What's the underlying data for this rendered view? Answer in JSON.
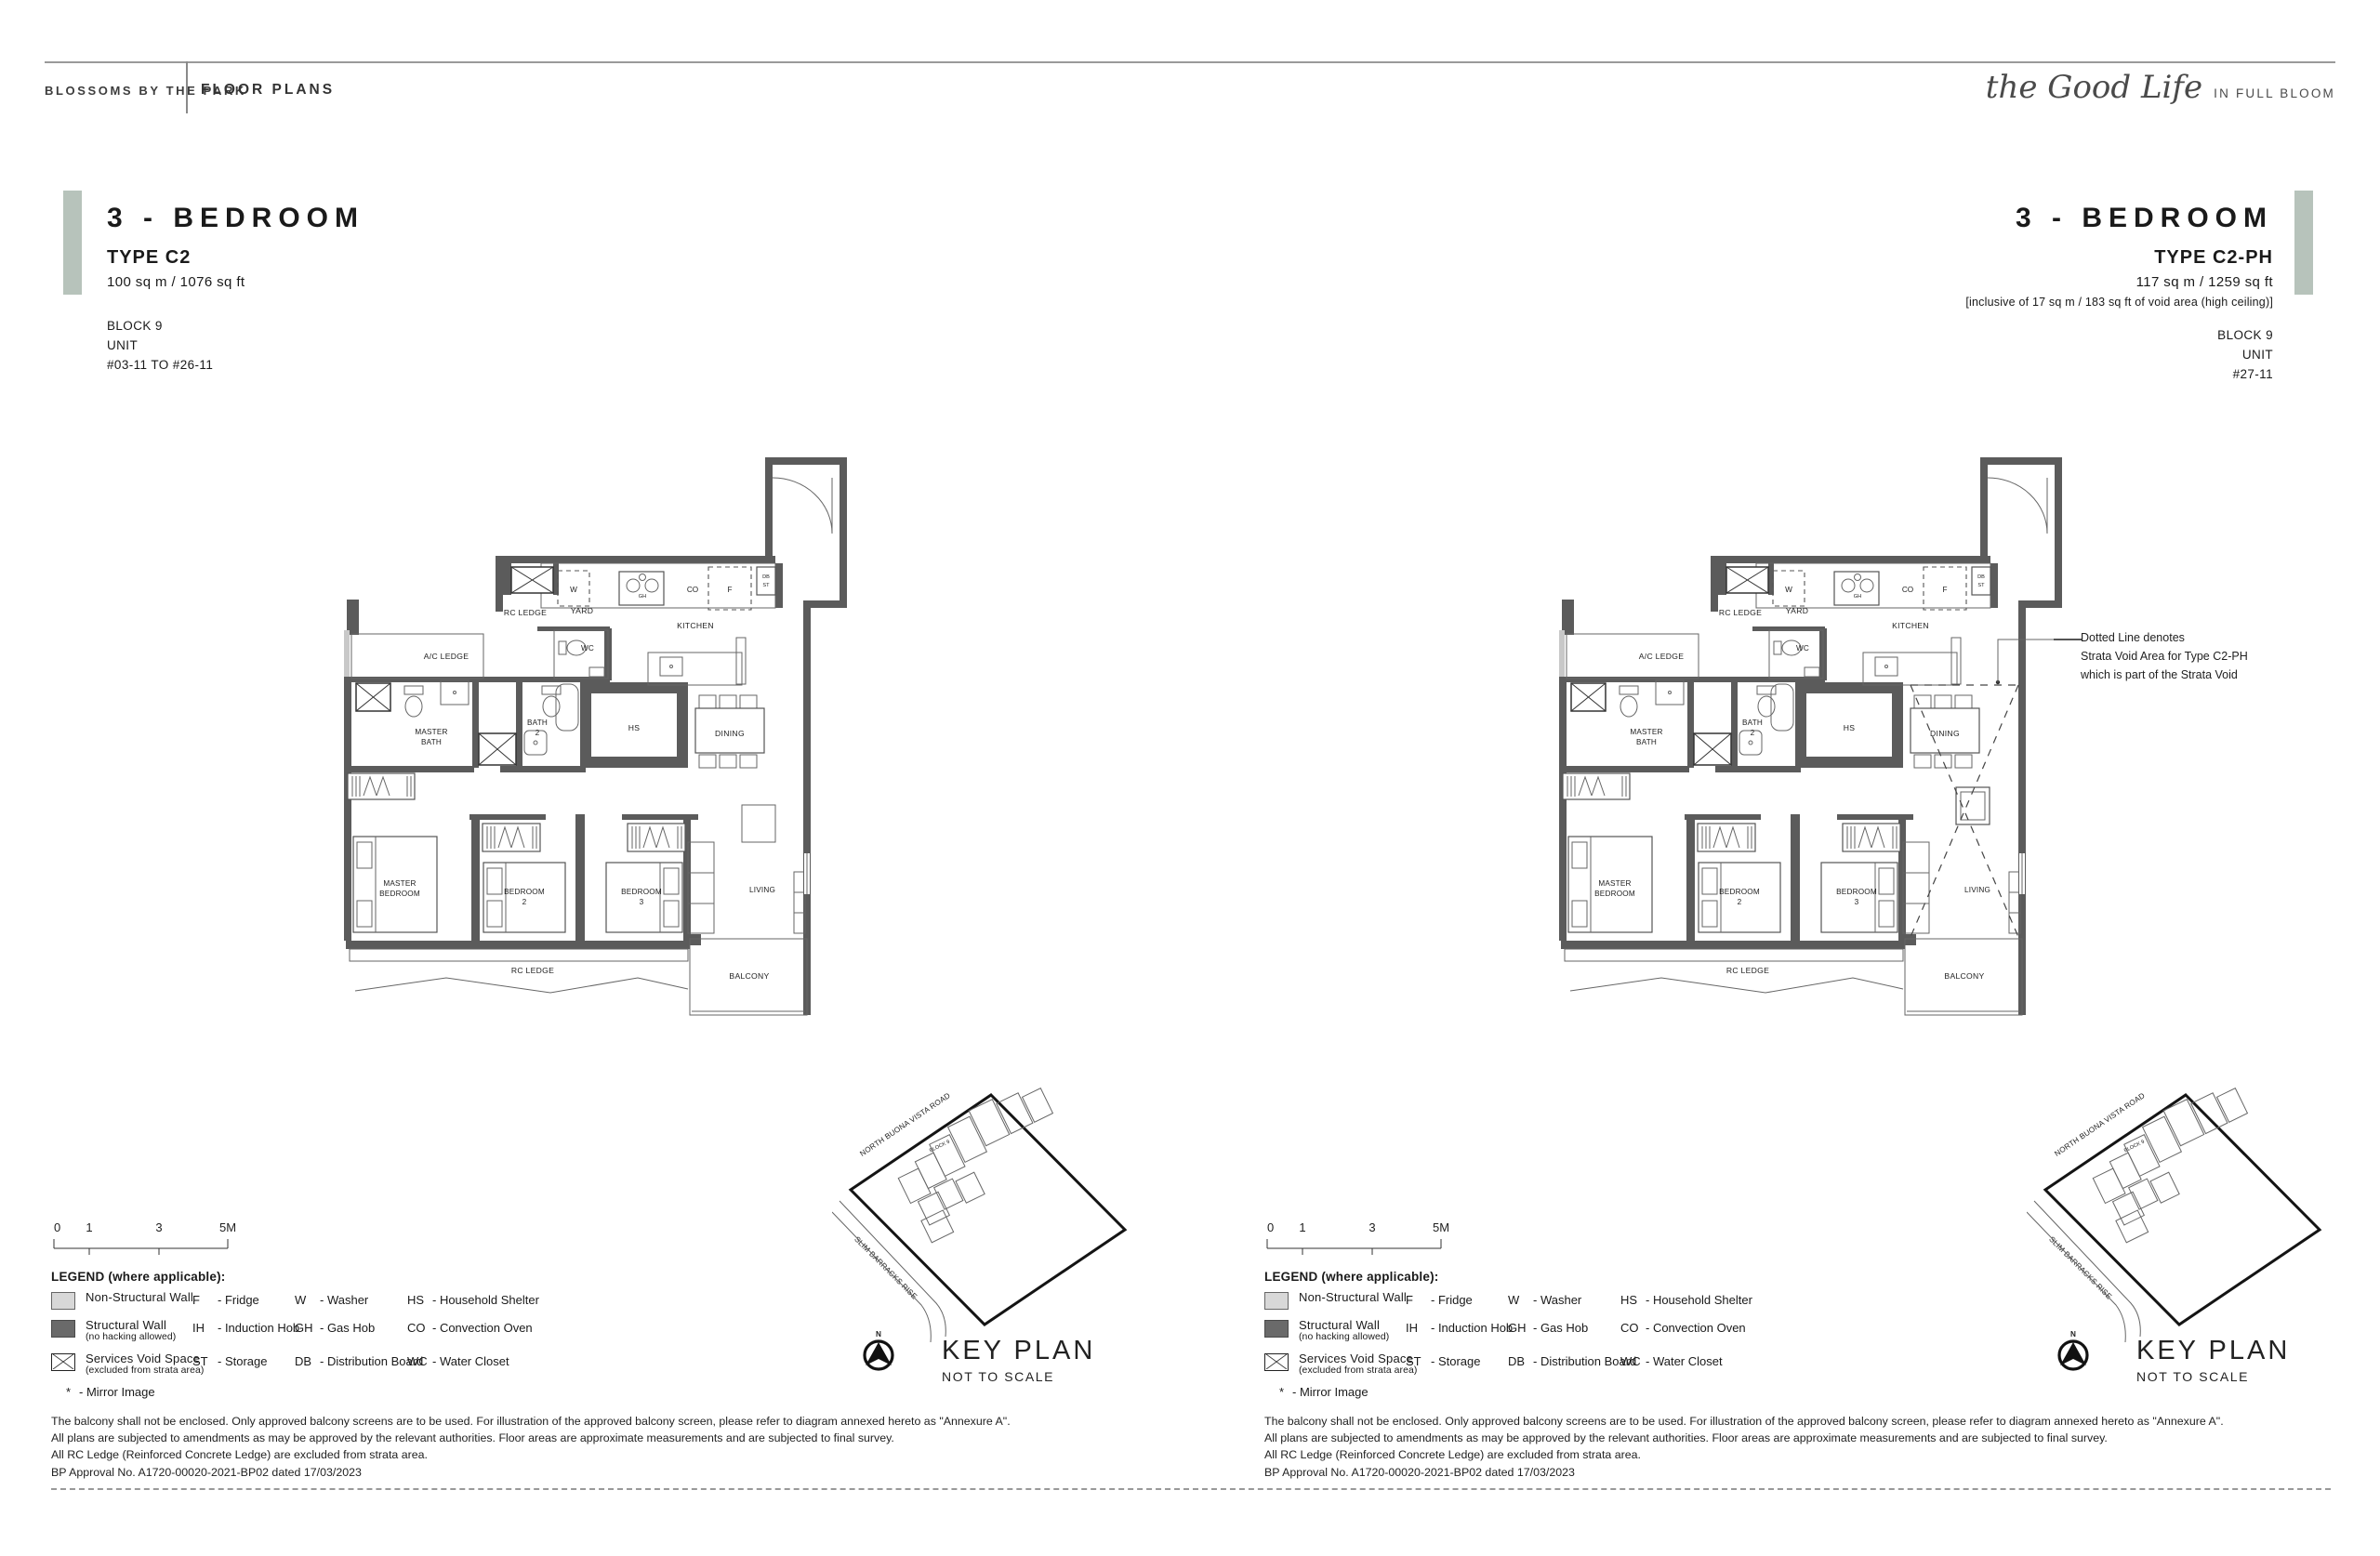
{
  "colors": {
    "accent": "#b7c3bb",
    "wall_dark": "#5b5b5b",
    "wall_light": "#c8c8c8"
  },
  "header": {
    "brand": "BLOSSOMS BY THE PARK",
    "section": "FLOOR PLANS",
    "logo_script": "the Good Life",
    "logo_tagline": "IN FULL BLOOM"
  },
  "panels": [
    {
      "title": "3 - BEDROOM",
      "type": "TYPE C2",
      "area": "100 sq m / 1076 sq ft",
      "block": "BLOCK 9",
      "unit_label": "UNIT",
      "units": "#03-11 TO #26-11"
    },
    {
      "title": "3 - BEDROOM",
      "type": "TYPE C2-PH",
      "area": "117 sq m / 1259 sq ft",
      "void_note": "[inclusive of 17 sq m / 183 sq ft of void area (high ceiling)]",
      "block": "BLOCK 9",
      "unit_label": "UNIT",
      "units": "#27-11",
      "strata_note": [
        "Dotted Line denotes",
        "Strata Void Area for Type C2-PH",
        "which is part of the Strata Void"
      ]
    }
  ],
  "floorplan": {
    "rooms": {
      "rc_ledge_top": "RC LEDGE",
      "yard": "YARD",
      "kitchen": "KITCHEN",
      "wc": "WC",
      "ac_ledge": "A/C LEDGE",
      "master_bath": [
        "MASTER",
        "BATH"
      ],
      "bath2": [
        "BATH",
        "2"
      ],
      "hs": "HS",
      "dining": "DINING",
      "master_bedroom": [
        "MASTER",
        "BEDROOM"
      ],
      "bedroom2": [
        "BEDROOM",
        "2"
      ],
      "bedroom3": [
        "BEDROOM",
        "3"
      ],
      "living": "LIVING",
      "rc_ledge_bottom": "RC LEDGE",
      "balcony": "BALCONY"
    },
    "appliances": {
      "washer": "W",
      "gas_hob": "GH",
      "convection_oven": "CO",
      "fridge": "F",
      "db": "DB",
      "st": "ST"
    }
  },
  "scalebar": {
    "labels": [
      "0",
      "1",
      "3",
      "5M"
    ]
  },
  "legend": {
    "title": "LEGEND (where applicable):",
    "symbols": [
      {
        "label": "Non-Structural Wall",
        "sub": ""
      },
      {
        "label": "Structural Wall",
        "sub": "(no hacking allowed)"
      },
      {
        "label": "Services Void Space",
        "sub": "(excluded from strata area)"
      }
    ],
    "mirror_key": "*",
    "mirror_label": "- Mirror Image",
    "abbreviations": [
      [
        [
          "F",
          "Fridge"
        ],
        [
          "IH",
          "Induction Hob"
        ],
        [
          "ST",
          "Storage"
        ]
      ],
      [
        [
          "W",
          "Washer"
        ],
        [
          "GH",
          "Gas Hob"
        ],
        [
          "DB",
          "Distribution Board"
        ]
      ],
      [
        [
          "HS",
          "Household Shelter"
        ],
        [
          "CO",
          "Convection Oven"
        ],
        [
          "WC",
          "Water Closet"
        ]
      ]
    ]
  },
  "keyplan": {
    "title": "KEY PLAN",
    "subtitle": "NOT TO SCALE",
    "north": "N",
    "block": "BLOCK 9",
    "road_top": "NORTH BUONA VISTA ROAD",
    "road_left": "SLIM BARRACKS RISE"
  },
  "disclaimer": [
    "The balcony shall not be enclosed. Only approved balcony screens are to be used. For illustration of the approved balcony screen, please refer to diagram annexed hereto as \"Annexure A\".",
    "All plans are subjected to amendments as may be approved by the relevant authorities. Floor areas are approximate measurements and are subjected to final survey.",
    "All RC Ledge (Reinforced Concrete Ledge) are excluded from strata area.",
    "BP Approval No. A1720-00020-2021-BP02 dated 17/03/2023"
  ]
}
